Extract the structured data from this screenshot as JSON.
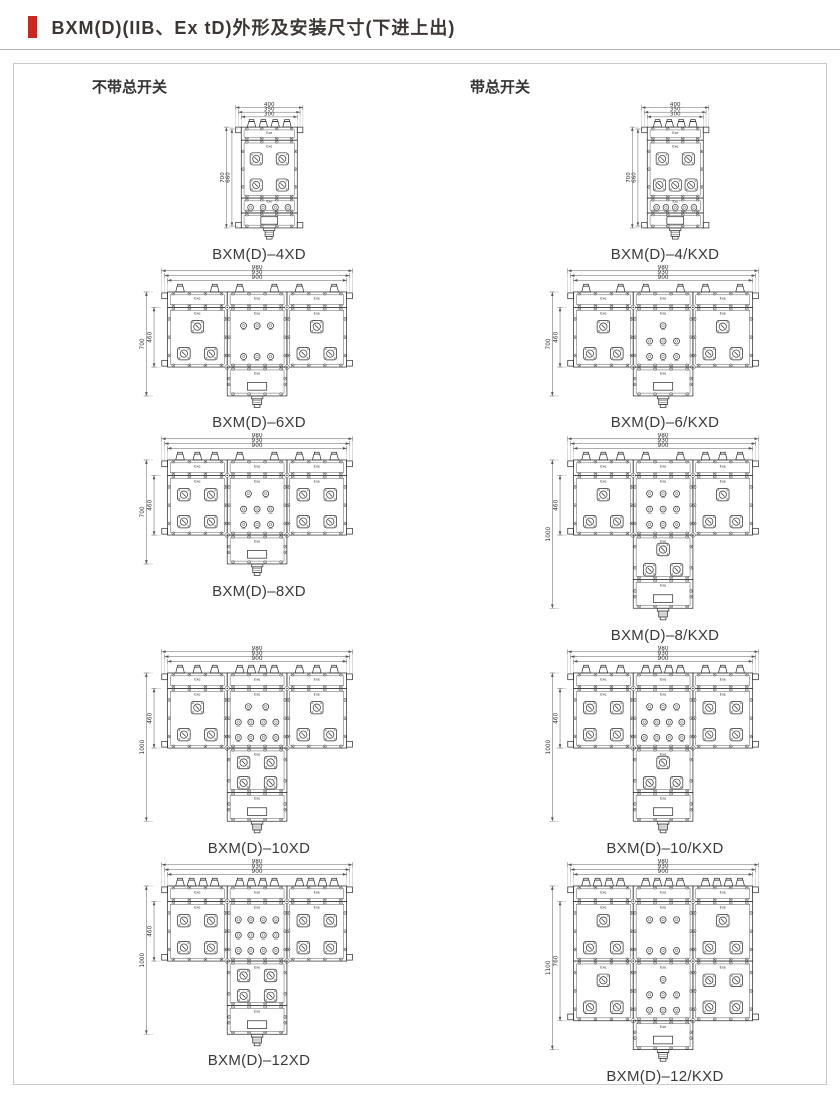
{
  "page": {
    "title": "BXM(D)(IIB、Ex tD)外形及安装尺寸(下进上出)",
    "accent_color": "#cf2420"
  },
  "columns": [
    {
      "header": "不带总开关"
    },
    {
      "header": "带总开关"
    }
  ],
  "marking": "Exe",
  "rows": [
    {
      "left": {
        "caption": "BXM(D)–4XD",
        "type": "narrow",
        "dims_top": [
          "400",
          "350",
          "300"
        ],
        "dims_side": [
          "700",
          "660"
        ],
        "terminals": 4,
        "squares_rows": [
          2,
          2
        ],
        "buttons": 4
      },
      "right": {
        "caption": "BXM(D)–4/KXD",
        "type": "narrow",
        "dims_top": [
          "400",
          "350",
          "300"
        ],
        "dims_side": [
          "700",
          "660"
        ],
        "terminals": 4,
        "squares_rows": [
          2,
          3
        ],
        "buttons": 5
      }
    },
    {
      "left": {
        "caption": "BXM(D)–6XD",
        "type": "wide",
        "dims_top": [
          "980",
          "930",
          "900"
        ],
        "dims_side": [
          "700",
          "460"
        ],
        "terminals": [
          2,
          2,
          2
        ],
        "left_squares": [
          1,
          2
        ],
        "right_squares": [
          1,
          2
        ],
        "mid_buttons": [
          3,
          3
        ],
        "lower_squares": null
      },
      "right": {
        "caption": "BXM(D)–6/KXD",
        "type": "wide",
        "dims_top": [
          "980",
          "930",
          "900"
        ],
        "dims_side": [
          "700",
          "460"
        ],
        "terminals": [
          2,
          2,
          2
        ],
        "left_squares": [
          1,
          2
        ],
        "right_squares": [
          1,
          2
        ],
        "mid_buttons": [
          1,
          3,
          3
        ],
        "lower_squares": null
      }
    },
    {
      "left": {
        "caption": "BXM(D)–8XD",
        "type": "wide",
        "dims_top": [
          "980",
          "930",
          "900"
        ],
        "dims_side": [
          "700",
          "460"
        ],
        "terminals": [
          3,
          2,
          3
        ],
        "left_squares": [
          2,
          2
        ],
        "right_squares": [
          2,
          2
        ],
        "mid_buttons": [
          2,
          3,
          3
        ],
        "lower_squares": null
      },
      "right": {
        "caption": "BXM(D)–8/KXD",
        "type": "wide",
        "dims_top": [
          "980",
          "930",
          "900"
        ],
        "dims_side": [
          "1000",
          "460"
        ],
        "terminals": [
          3,
          2,
          3
        ],
        "left_squares": [
          1,
          2
        ],
        "right_squares": [
          1,
          2
        ],
        "mid_buttons": [
          3,
          3,
          3
        ],
        "lower_squares": [
          1,
          2
        ]
      }
    },
    {
      "left": {
        "caption": "BXM(D)–10XD",
        "type": "wide",
        "dims_top": [
          "980",
          "930",
          "900"
        ],
        "dims_side": [
          "1000",
          "460"
        ],
        "terminals": [
          3,
          4,
          3
        ],
        "left_squares": [
          1,
          2
        ],
        "right_squares": [
          1,
          2
        ],
        "mid_buttons": [
          2,
          4,
          4
        ],
        "lower_squares": [
          2,
          2
        ]
      },
      "right": {
        "caption": "BXM(D)–10/KXD",
        "type": "wide",
        "dims_top": [
          "980",
          "930",
          "900"
        ],
        "dims_side": [
          "1000",
          "460"
        ],
        "terminals": [
          3,
          4,
          3
        ],
        "left_squares": [
          2,
          2
        ],
        "right_squares": [
          2,
          2
        ],
        "mid_buttons": [
          3,
          4,
          4
        ],
        "lower_squares": [
          1,
          2
        ]
      }
    },
    {
      "left": {
        "caption": "BXM(D)–12XD",
        "type": "wide",
        "dims_top": [
          "980",
          "930",
          "900"
        ],
        "dims_side": [
          "1000",
          "460"
        ],
        "terminals": [
          4,
          4,
          4
        ],
        "left_squares": [
          2,
          2
        ],
        "right_squares": [
          2,
          2
        ],
        "mid_buttons": [
          4,
          4,
          4
        ],
        "lower_squares": [
          2,
          2
        ]
      },
      "right": {
        "caption": "BXM(D)–12/KXD",
        "type": "wide",
        "dims_top": [
          "980",
          "930",
          "900"
        ],
        "dims_side": [
          "1100",
          "760"
        ],
        "terminals": [
          4,
          4,
          4
        ],
        "left_squares": [
          1,
          2
        ],
        "right_squares": [
          1,
          2
        ],
        "mid_buttons": [
          3,
          3
        ],
        "second_row": {
          "left_squares": [
            1,
            2
          ],
          "right_squares": [
            2,
            2
          ],
          "mid_buttons": [
            1,
            3,
            3
          ]
        },
        "lower_squares": null
      }
    }
  ]
}
